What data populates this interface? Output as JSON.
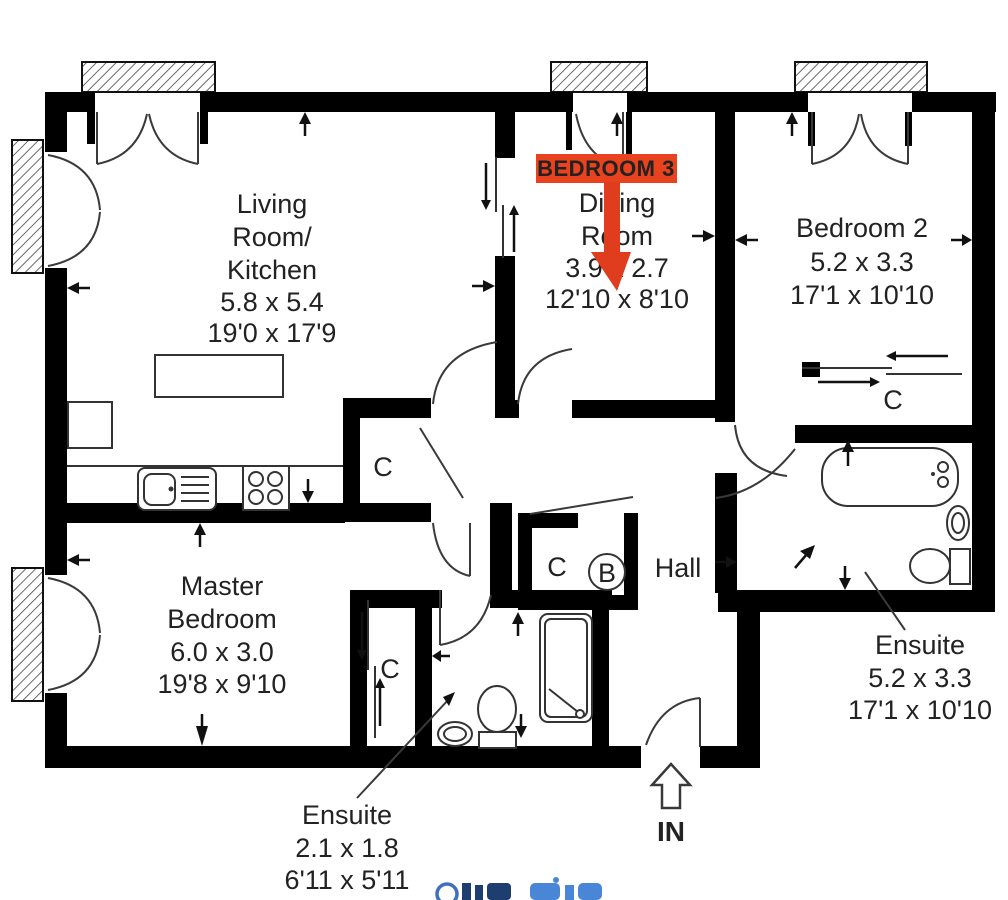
{
  "plan": {
    "highlight": {
      "label": "BEDROOM 3"
    },
    "rooms": {
      "living": {
        "lines": [
          "Living",
          "Room/",
          "Kitchen"
        ],
        "metric": "5.8 x 5.4",
        "imperial": "19'0 x 17'9"
      },
      "dining": {
        "lines": [
          "Dining",
          "Room"
        ],
        "metric": "3.9 x 2.7",
        "imperial": "12'10 x 8'10"
      },
      "bedroom2": {
        "name": "Bedroom 2",
        "metric": "5.2 x 3.3",
        "imperial": "17'1 x 10'10"
      },
      "master": {
        "lines": [
          "Master",
          "Bedroom"
        ],
        "metric": "6.0 x 3.0",
        "imperial": "19'8 x 9'10"
      },
      "hall": {
        "name": "Hall"
      },
      "ensuite_upper": {
        "name": "Ensuite",
        "metric": "5.2 x 3.3",
        "imperial": "17'1 x 10'10"
      },
      "ensuite_master": {
        "name": "Ensuite",
        "metric": "2.1 x 1.8",
        "imperial": "6'11 x 5'11"
      }
    },
    "markers": {
      "cupboard": "C",
      "boiler": "B",
      "entrance": "IN"
    },
    "colors": {
      "walls": "#000000",
      "highlight_bg": "#e8421e",
      "highlight_text": "#ffd800",
      "arrow": "#e03c1e",
      "watermark_dark": "#1d3e6e",
      "watermark_light": "#4a86d8"
    },
    "footer": {
      "note": "logo cut off at bottom edge"
    }
  }
}
